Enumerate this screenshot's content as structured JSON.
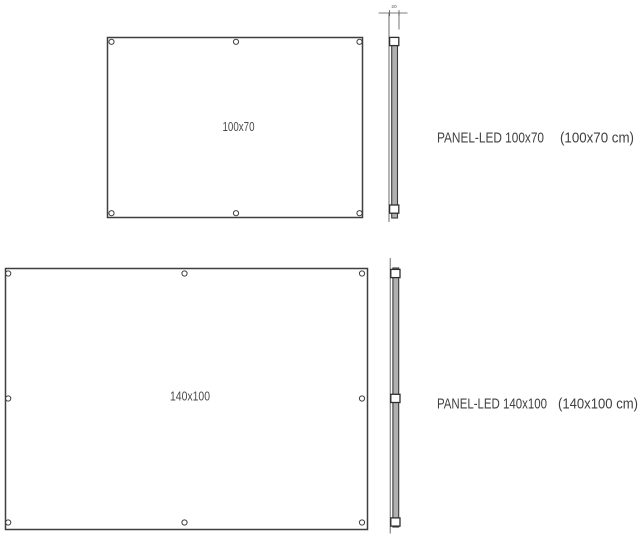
{
  "diagram": {
    "colors": {
      "background": "#ffffff",
      "line": "#3f3f3f",
      "text": "#414141",
      "profile_fill": "#b0b0b0"
    },
    "panel_100x70": {
      "front_view_label": "100x70",
      "thickness_dimension": "20",
      "caption_name": "PANEL-LED 100x70",
      "caption_size": "(100x70 cm)"
    },
    "panel_140x100": {
      "front_view_label": "140x100",
      "caption_name": "PANEL-LED 140x100",
      "caption_size": "(140x100 cm)"
    }
  }
}
